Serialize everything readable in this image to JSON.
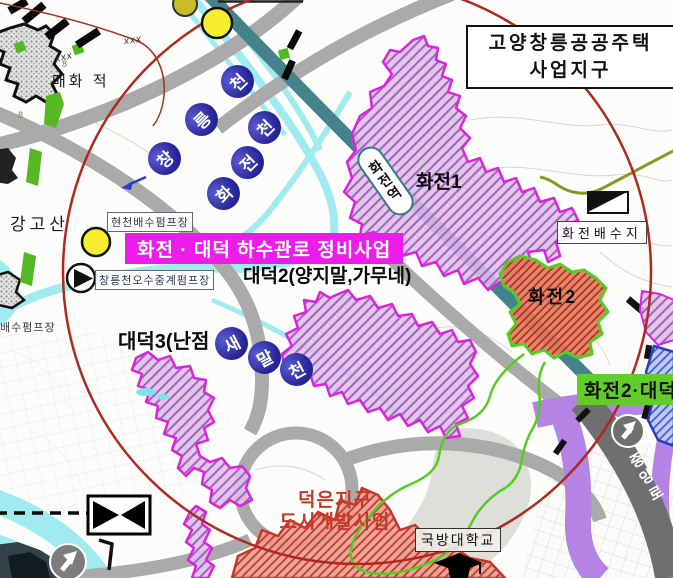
{
  "header": {
    "region_line1": "고양창릉공공주택",
    "region_line2": "사업지구"
  },
  "banner": {
    "title": "화전 · 대덕 하수관로 정비사업"
  },
  "areas": {
    "hwajeon1": "화전1",
    "hwajeon2": "화전2",
    "daedeok2": "대덕2(양지말,가무네)",
    "daedeok3": "대덕3(난점",
    "deokeun_line1": "덕은지구",
    "deokeun_line2": "도시개발사업",
    "green_banner": "화전2·대덕"
  },
  "station": {
    "name": "화전역"
  },
  "facilities": {
    "hyeoncheon_pump": "현천배수펌프장",
    "changneung_relay_pump": "창릉천오수중계펌프장",
    "pump_station_partial": "배수펌프장",
    "reservoir": "화전배수지",
    "university": "국방대학교"
  },
  "places": {
    "mountain": "강고산",
    "maehwa": "매화 적",
    "road": "중앙로"
  },
  "streams": {
    "changneung": [
      "창",
      "릉",
      "천"
    ],
    "hwajeon": [
      "화",
      "전",
      "천"
    ],
    "saemal": [
      "새",
      "말",
      "천"
    ]
  },
  "marks": {
    "xxx": "xxx",
    "spot_height": "8"
  },
  "colors": {
    "project_banner": "#ee1cea",
    "district_border": "#dd22dd",
    "railway": "#44838b",
    "stream": "#9febf0",
    "boundary_circle": "#b0291f",
    "green_boundary": "#55cc22",
    "green_banner_bg": "#62cc2a",
    "purple_road": "#b583e3",
    "label_circle": "#26269a",
    "redevelopment_text": "#c5392a"
  }
}
